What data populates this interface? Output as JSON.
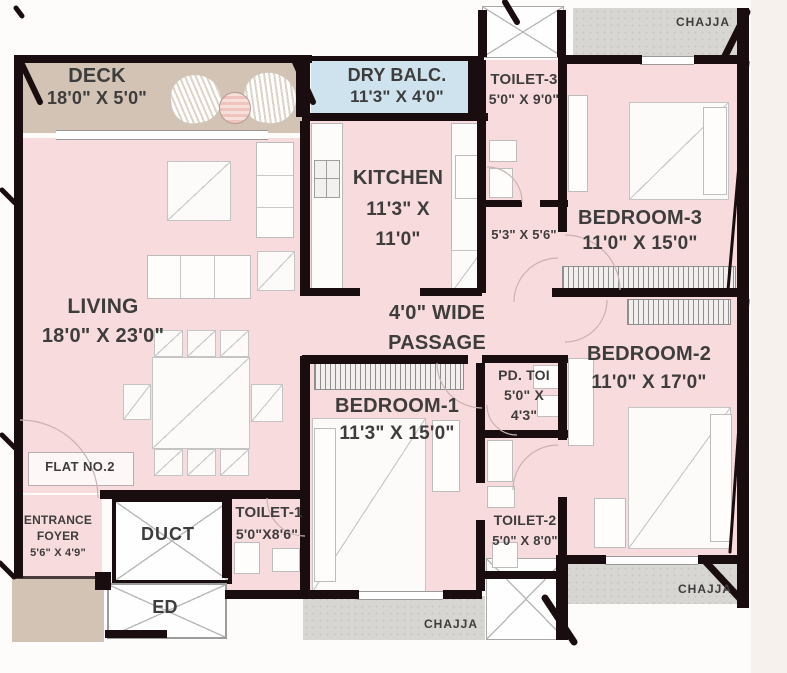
{
  "palette": {
    "room_pink": "#f8dbdc",
    "deck_tan": "#d2c3b4",
    "balcony_blue": "#cfe3ee",
    "chajja_gray": "#d8d6d3",
    "wall_black": "#1a0d10",
    "label_gray": "#3e3d3d"
  },
  "rooms": {
    "deck": {
      "name": "DECK",
      "size": "18'0\" X 5'0\""
    },
    "dry_balcony": {
      "name": "DRY BALC.",
      "size": "11'3\" X 4'0\""
    },
    "kitchen": {
      "name": "KITCHEN",
      "size_line1": "11'3\" X",
      "size_line2": "11'0\""
    },
    "living": {
      "name": "LIVING",
      "size": "18'0\" X 23'0\""
    },
    "passage": {
      "line1": "4'0\" WIDE",
      "line2": "PASSAGE"
    },
    "toilet3": {
      "name": "TOILET-3",
      "size": "5'0\" X 9'0\""
    },
    "dress": {
      "size": "5'3\" X 5'6\""
    },
    "bedroom3": {
      "name": "BEDROOM-3",
      "size": "11'0\" X 15'0\""
    },
    "bedroom2": {
      "name": "BEDROOM-2",
      "size": "11'0\" X 17'0\""
    },
    "bedroom1": {
      "name": "BEDROOM-1",
      "size": "11'3\" X 15'0\""
    },
    "pd_toilet": {
      "name": "PD. TOI",
      "size_line1": "5'0\" X",
      "size_line2": "4'3\""
    },
    "toilet2": {
      "name": "TOILET-2",
      "size": "5'0\" X 8'0\""
    },
    "toilet1": {
      "name": "TOILET-1",
      "size": "5'0\"X8'6\""
    },
    "entrance_foyer": {
      "name_line1": "ENTRANCE",
      "name_line2": "FOYER",
      "size": "5'6\" X 4'9\""
    },
    "duct": {
      "name": "DUCT"
    },
    "ed": {
      "name": "ED"
    },
    "flat": {
      "label": "FLAT NO.2"
    }
  },
  "annotations": {
    "chajja_top": "CHAJJA",
    "chajja_bottom_middle": "CHAJJA",
    "chajja_bottom_right": "CHAJJA"
  }
}
